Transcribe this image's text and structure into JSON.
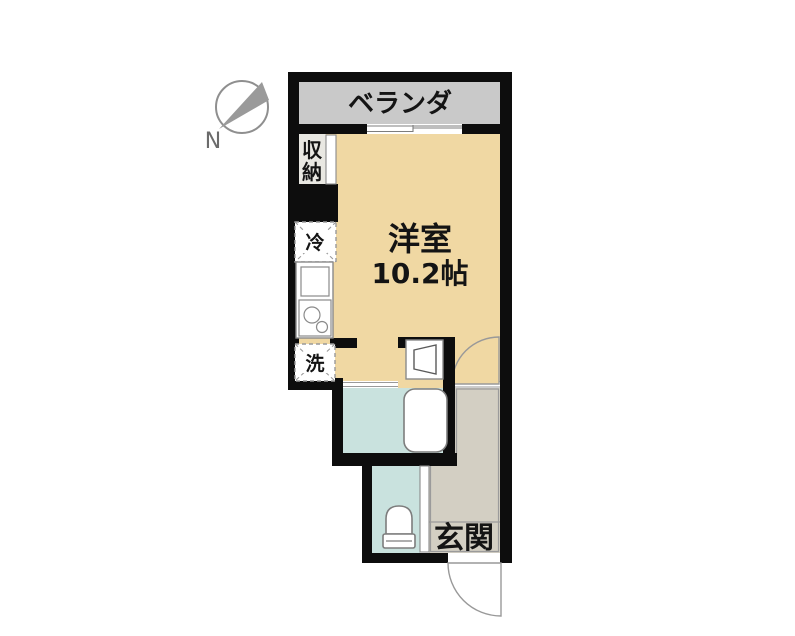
{
  "plan": {
    "compass_label": "N",
    "rooms": {
      "balcony": "ベランダ",
      "storage_line1": "収",
      "storage_line2": "納",
      "refrigerator": "冷",
      "washer": "洗",
      "main_room_name": "洋室",
      "main_room_size": "10.2帖",
      "entrance": "玄関"
    },
    "colors": {
      "wall": "#0d0d0d",
      "main_room": "#f0d8a3",
      "balcony": "#c9c9c9",
      "entrance": "#d3cfc3",
      "wet_area": "#c9e2de",
      "storage": "#e9e8e2",
      "fixture_outline": "#878787",
      "thin_line": "#999999",
      "compass_needle": "#9a9a9a",
      "compass_ring": "#8f8f8f"
    }
  }
}
